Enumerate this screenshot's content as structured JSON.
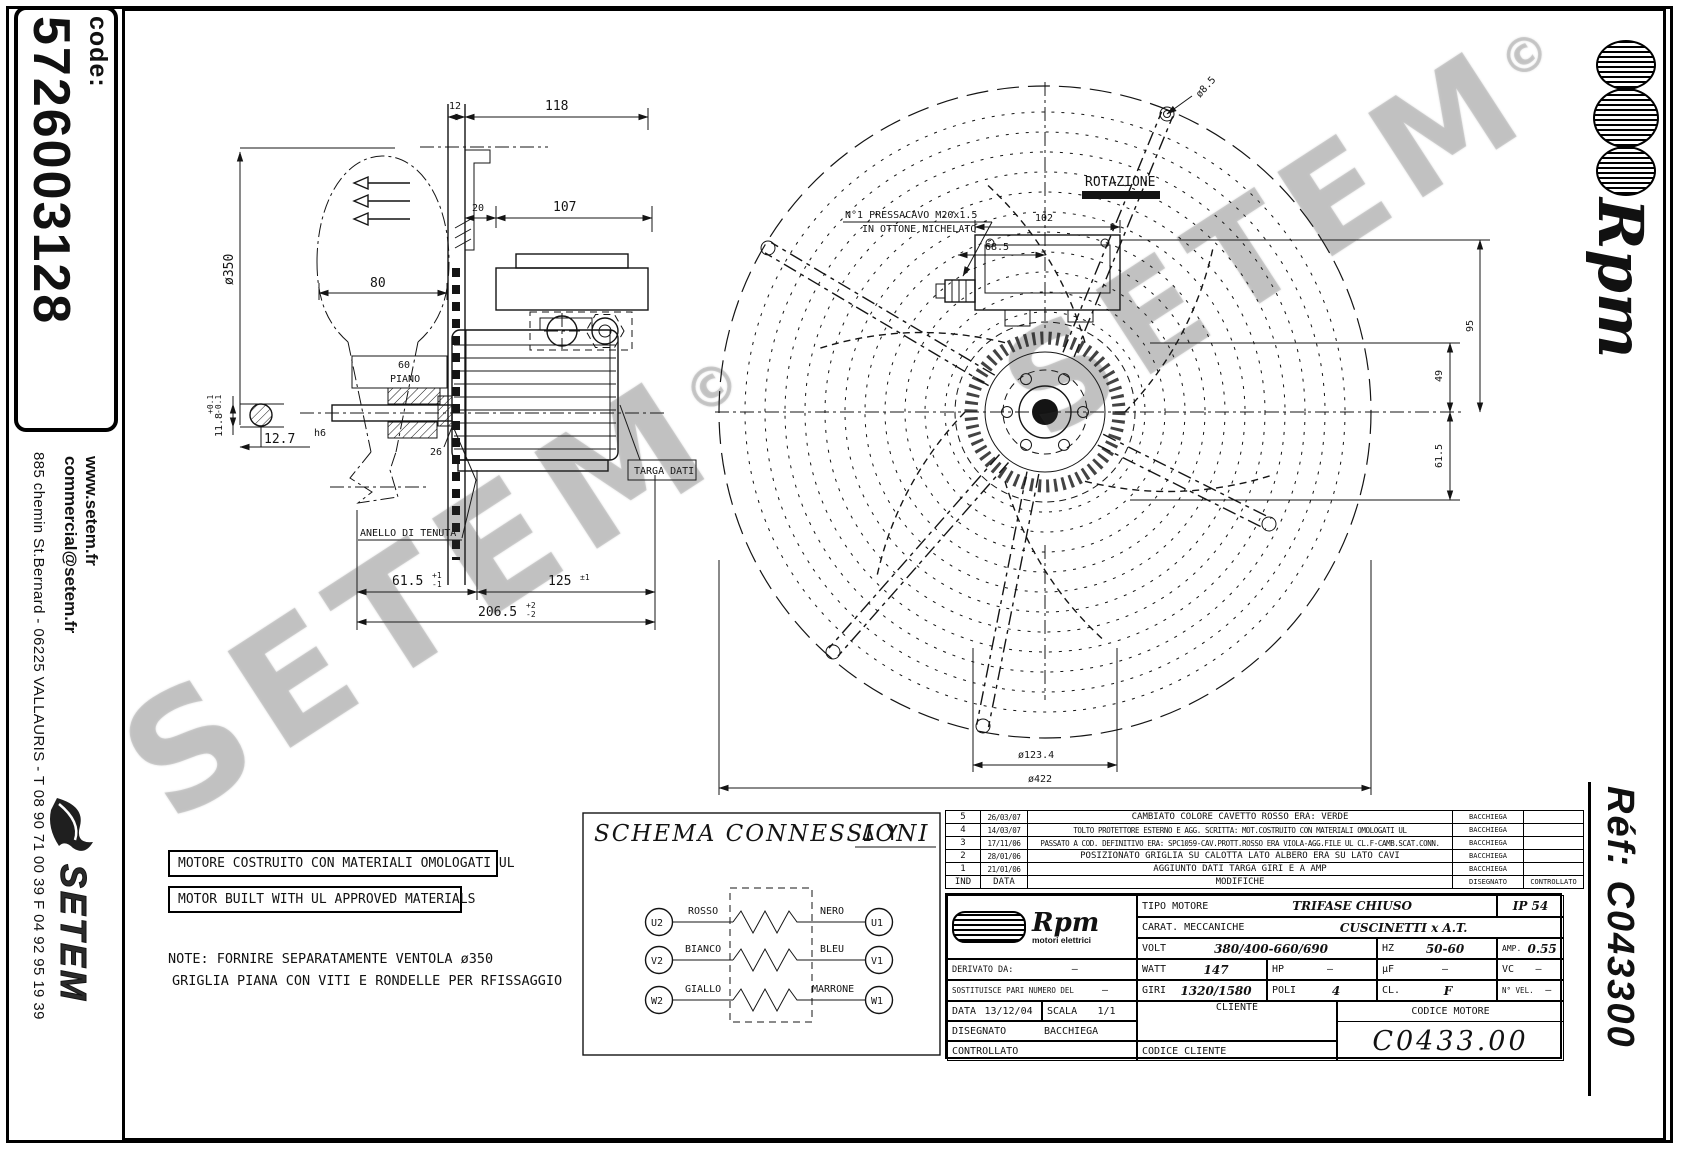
{
  "left_margin": {
    "code_label": "code:",
    "code_value": "5726003128",
    "address": "885 chemin St.Bernard  -  06225 VALLAURIS  -  T 08 90 71 00 39  F 04 92 95 19 39",
    "website": "www.setem.fr",
    "email": "commercial@setem.fr",
    "logo_text": "SETEM"
  },
  "right_margin": {
    "brand": "Rpm",
    "ref_text": "Réf:  C043300"
  },
  "watermark": {
    "text": "SETEM",
    "copyright": "©"
  },
  "side_view": {
    "dim_12": "12",
    "dim_118": "118",
    "dim_20": "20",
    "dim_107": "107",
    "dim_350": "ø350",
    "dim_80": "80",
    "dim_60": "60",
    "label_piano": "PIANO",
    "dim_26": "26",
    "dim_12_7": "12.7",
    "tol_h6": "h6",
    "dim_11_8": "11.8",
    "tol_11_8_p": "+0.1",
    "tol_11_8_m": "-0.1",
    "dim_61_5": "61.5",
    "tol_61_5_p": "+1",
    "tol_61_5_m": "-1",
    "dim_125": "125",
    "tol_125": "±1",
    "dim_206_5": "206.5",
    "tol_206_5_p": "+2",
    "tol_206_5_m": "-2",
    "label_anello": "ANELLO DI TENUTA",
    "label_targa": "TARGA DATI"
  },
  "fan_view": {
    "label_rotazione": "ROTAZIONE",
    "pressacavo_1": "N°1 PRESSACAVO M20x1.5",
    "pressacavo_2": "IN OTTONE NICHELATO",
    "dim_102": "102",
    "dim_68_5": "68.5",
    "dim_95": "95",
    "dim_49": "49",
    "dim_61_5": "61.5",
    "dim_8_5": "ø8.5",
    "dim_123_4": "ø123.4",
    "dim_422": "ø422"
  },
  "notes": {
    "box1": "MOTORE COSTRUITO CON MATERIALI OMOLOGATI UL",
    "box2": "MOTOR BUILT WITH UL APPROVED MATERIALS",
    "note_line1": "NOTE: FORNIRE SEPARATAMENTE VENTOLA ø350",
    "note_line2": "GRIGLIA PIANA CON VITI E RONDELLE PER RFISSAGGIO"
  },
  "schema": {
    "title": "SCHEMA CONNESSIONI",
    "symbols": "Δ  Y",
    "rows": [
      {
        "left_terminal": "U2",
        "left_wire": "ROSSO",
        "right_wire": "NERO",
        "right_terminal": "U1"
      },
      {
        "left_terminal": "V2",
        "left_wire": "BIANCO",
        "right_wire": "BLEU",
        "right_terminal": "V1"
      },
      {
        "left_terminal": "W2",
        "left_wire": "GIALLO",
        "right_wire": "MARRONE",
        "right_terminal": "W1"
      }
    ]
  },
  "revisions": {
    "headers": {
      "ind": "IND",
      "data": "DATA",
      "modifiche": "MODIFICHE",
      "disegnato": "DISEGNATO",
      "controllato": "CONTROLLATO"
    },
    "rows": [
      {
        "ind": "5",
        "date": "26/03/07",
        "text": "CAMBIATO COLORE CAVETTO ROSSO ERA: VERDE",
        "by": "BACCHIEGA"
      },
      {
        "ind": "4",
        "date": "14/03/07",
        "text": "TOLTO PROTETTORE ESTERNO E AGG. SCRITTA: MOT.COSTRUITO CON MATERIALI OMOLOGATI UL",
        "by": "BACCHIEGA"
      },
      {
        "ind": "3",
        "date": "17/11/06",
        "text": "PASSATO A COD. DEFINITIVO ERA: SPC1059-CAV.PROTT.ROSSO ERA VIOLA-AGG.FILE UL CL.F-CAMB.SCAT.CONN.",
        "by": "BACCHIEGA"
      },
      {
        "ind": "2",
        "date": "28/01/06",
        "text": "POSIZIONATO GRIGLIA SU CALOTTA LATO ALBERO ERA SU LATO CAVI",
        "by": "BACCHIEGA"
      },
      {
        "ind": "1",
        "date": "21/01/06",
        "text": "AGGIUNTO DATI TARGA GIRI E A AMP",
        "by": "BACCHIEGA"
      }
    ]
  },
  "title_block": {
    "brand": "Rpm",
    "brand_sub": "motori elettrici",
    "tipo_motore_label": "TIPO MOTORE",
    "tipo_motore": "TRIFASE CHIUSO",
    "ip": "IP 54",
    "carat_label": "CARAT. MECCANICHE",
    "carat": "CUSCINETTI x A.T.",
    "volt_label": "VOLT",
    "volt": "380/400-660/690",
    "hz_label": "HZ",
    "hz": "50-60",
    "amp_label": "AMP.",
    "amp": "0.55",
    "derivato_label": "DERIVATO DA:",
    "derivato": "—",
    "watt_label": "WATT",
    "watt": "147",
    "hp_label": "HP",
    "hp": "—",
    "uf_label": "μF",
    "uf": "—",
    "vc_label": "VC",
    "vc": "—",
    "sostituisce_label": "SOSTITUISCE PARI NUMERO DEL",
    "sostituisce": "–",
    "giri_label": "GIRI",
    "giri": "1320/1580",
    "poli_label": "POLI",
    "poli": "4",
    "cl_label": "CL.",
    "cl": "F",
    "nvel_label": "N° VEL.",
    "nvel": "—",
    "data_label": "DATA",
    "data": "13/12/04",
    "scala_label": "SCALA",
    "scala": "1/1",
    "cliente_label": "CLIENTE",
    "codice_motore_label": "CODICE MOTORE",
    "codice_motore": "C0433.00",
    "disegnato_label": "DISEGNATO",
    "disegnato": "BACCHIEGA",
    "controllato_label": "CONTROLLATO",
    "codice_cliente_label": "CODICE CLIENTE"
  }
}
